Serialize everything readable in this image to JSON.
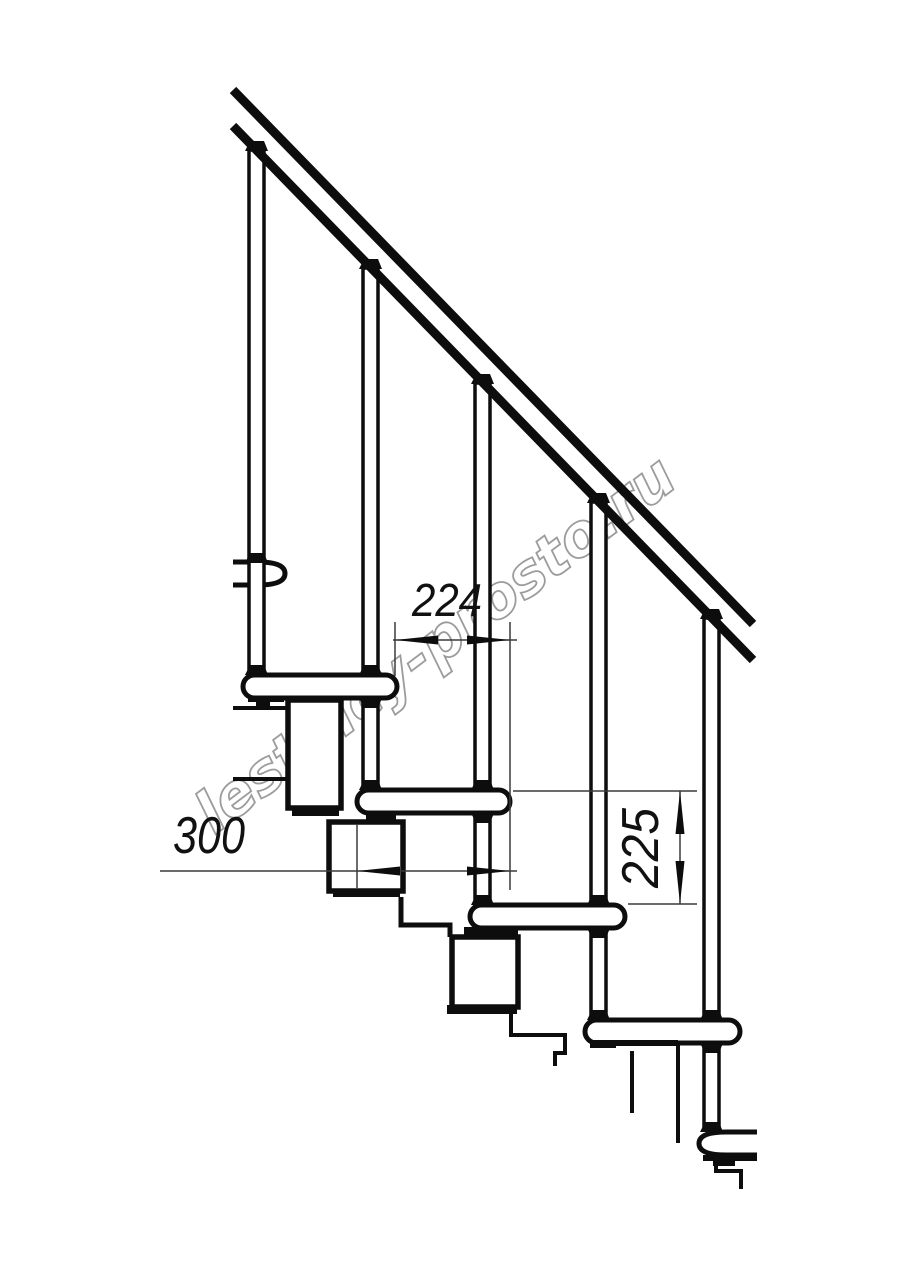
{
  "drawing": {
    "type": "staircase-side-view-technical-drawing",
    "background": "#ffffff",
    "ink_color": "#0d0d0d",
    "dim_line_color": "#3a3a3a",
    "dimensions": {
      "step_run_mm": "224",
      "tread_depth_mm": "300",
      "riser_height_mm": "225"
    },
    "watermark": {
      "text": "lestnicy-prosto.ru",
      "color": "#9c9c9c"
    },
    "parts": {
      "tread_count_visible": 6,
      "baluster_count_visible": 5
    }
  }
}
